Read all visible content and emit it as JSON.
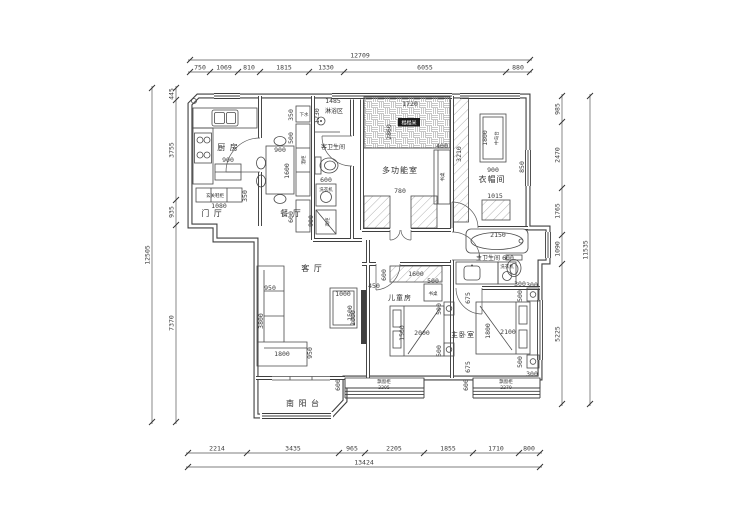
{
  "colors": {
    "line": "#3f3f3f",
    "dim_text": "#3d3d3d",
    "label_text": "#2e2e2e",
    "chip_bg": "#1b1b1b",
    "chip_text": "#ffffff",
    "background": "#ffffff"
  },
  "plan": {
    "rooms": [
      "厨房",
      "门厅",
      "餐厅",
      "淋浴区",
      "客卫生间",
      "多功能室",
      "衣帽间",
      "主卫生间",
      "客厅",
      "儿童房",
      "主卧室",
      "南阳台"
    ],
    "fixtures": [
      "玄关鞋柜",
      "下水",
      "酒柜",
      "洗衣机",
      "高柜",
      "榻榻米",
      "书桌",
      "中岛台",
      "飘窗柜"
    ]
  },
  "dim_chains": [
    {
      "n": "dim-top-total",
      "d": "h",
      "y": 60,
      "a": 190,
      "b": 530,
      "ticks": [
        190,
        530
      ],
      "labels": [
        {
          "t": "12709",
          "p": 360
        }
      ]
    },
    {
      "n": "dim-top-segments",
      "d": "h",
      "y": 72,
      "a": 190,
      "b": 530,
      "ticks": [
        190,
        210,
        238,
        260,
        309,
        344,
        506,
        530
      ],
      "labels": [
        {
          "t": "750",
          "p": 200
        },
        {
          "t": "1069",
          "p": 224
        },
        {
          "t": "810",
          "p": 249
        },
        {
          "t": "1815",
          "p": 284
        },
        {
          "t": "1330",
          "p": 326
        },
        {
          "t": "6055",
          "p": 425
        },
        {
          "t": "880",
          "p": 518
        }
      ]
    },
    {
      "n": "dim-bottom-segments",
      "d": "h",
      "y": 453,
      "a": 188,
      "b": 540,
      "ticks": [
        188,
        247,
        339,
        365,
        424,
        473,
        519,
        540
      ],
      "labels": [
        {
          "t": "2214",
          "p": 217
        },
        {
          "t": "3435",
          "p": 293
        },
        {
          "t": "965",
          "p": 352
        },
        {
          "t": "2205",
          "p": 394
        },
        {
          "t": "1855",
          "p": 448
        },
        {
          "t": "1710",
          "p": 496
        },
        {
          "t": "800",
          "p": 529
        }
      ]
    },
    {
      "n": "dim-bottom-total",
      "d": "h",
      "y": 467,
      "a": 188,
      "b": 540,
      "ticks": [
        188,
        540
      ],
      "labels": [
        {
          "t": "13424",
          "p": 364
        }
      ]
    },
    {
      "n": "dim-left-segments",
      "d": "v",
      "x": 176,
      "a": 88,
      "b": 422,
      "ticks": [
        88,
        100,
        200,
        225,
        422
      ],
      "labels": [
        {
          "t": "445",
          "p": 94
        },
        {
          "t": "3755",
          "p": 150
        },
        {
          "t": "935",
          "p": 212
        },
        {
          "t": "7370",
          "p": 323
        }
      ]
    },
    {
      "n": "dim-left-total",
      "d": "v",
      "x": 152,
      "a": 88,
      "b": 422,
      "ticks": [
        88,
        422
      ],
      "labels": [
        {
          "t": "12505",
          "p": 255
        }
      ]
    },
    {
      "n": "dim-right-segments",
      "d": "v",
      "x": 562,
      "a": 96,
      "b": 404,
      "ticks": [
        96,
        122,
        188,
        235,
        264,
        404
      ],
      "labels": [
        {
          "t": "985",
          "p": 109
        },
        {
          "t": "2470",
          "p": 155
        },
        {
          "t": "1765",
          "p": 211
        },
        {
          "t": "1090",
          "p": 249
        },
        {
          "t": "5225",
          "p": 334
        }
      ]
    },
    {
      "n": "dim-right-total",
      "d": "v",
      "x": 590,
      "a": 96,
      "b": 404,
      "ticks": [
        96,
        404
      ],
      "labels": [
        {
          "t": "11535",
          "p": 250
        }
      ]
    }
  ],
  "annotations": [
    {
      "n": "room-kitchen",
      "t": "厨 房",
      "x": 228,
      "y": 150,
      "s": 8,
      "cls": "room"
    },
    {
      "n": "room-entry",
      "t": "门 厅",
      "x": 212,
      "y": 216,
      "s": 8,
      "cls": "room"
    },
    {
      "n": "room-dining",
      "t": "餐 厅",
      "x": 291,
      "y": 216,
      "s": 8,
      "cls": "room"
    },
    {
      "n": "room-shower",
      "t": "淋浴区",
      "x": 334,
      "y": 113,
      "s": 6,
      "cls": "mid"
    },
    {
      "n": "room-guest-bath",
      "t": "客卫生间",
      "x": 333,
      "y": 149,
      "s": 6,
      "cls": "mid"
    },
    {
      "n": "room-multi",
      "t": "多功能室",
      "x": 400,
      "y": 173,
      "s": 8,
      "cls": "room"
    },
    {
      "n": "room-cloak",
      "t": "衣帽间",
      "x": 492,
      "y": 182,
      "s": 8,
      "cls": "room"
    },
    {
      "n": "room-master-bath",
      "t": "主卫生间",
      "x": 488,
      "y": 260,
      "s": 6,
      "cls": "mid"
    },
    {
      "n": "room-living",
      "t": "客 厅",
      "x": 312,
      "y": 271,
      "s": 8,
      "cls": "room"
    },
    {
      "n": "room-kids",
      "t": "儿童房",
      "x": 400,
      "y": 300,
      "s": 7,
      "cls": "room"
    },
    {
      "n": "room-master",
      "t": "主卧室",
      "x": 463,
      "y": 337,
      "s": 7,
      "cls": "room"
    },
    {
      "n": "room-balcony",
      "t": "南 阳 台",
      "x": 303,
      "y": 406,
      "s": 8,
      "cls": "room"
    },
    {
      "n": "label-shoe-cabinet",
      "t": "玄关鞋柜",
      "x": 215,
      "y": 197,
      "cls": "tiny"
    },
    {
      "n": "label-drain",
      "t": "下水",
      "x": 304,
      "y": 116,
      "cls": "tiny"
    },
    {
      "n": "label-wine-cabinet",
      "t": "酒柜",
      "x": 305,
      "y": 160,
      "r": 1,
      "cls": "tiny"
    },
    {
      "n": "label-washer-guest",
      "t": "洗衣机",
      "x": 326,
      "y": 191,
      "cls": "tiny"
    },
    {
      "n": "label-tall-cabinet",
      "t": "高柜",
      "x": 329,
      "y": 222,
      "r": 1,
      "cls": "tiny"
    },
    {
      "n": "chip-tatami",
      "t": "榻榻米",
      "x": 409,
      "y": 124,
      "c": 1
    },
    {
      "n": "label-desk-multi",
      "t": "书桌",
      "x": 444,
      "y": 177,
      "r": 1,
      "cls": "tiny"
    },
    {
      "n": "label-island",
      "t": "中岛台",
      "x": 498,
      "y": 138,
      "r": 1,
      "cls": "tiny"
    },
    {
      "n": "label-washer-master",
      "t": "洗衣机",
      "x": 507,
      "y": 268,
      "cls": "tiny"
    },
    {
      "n": "label-desk-kids",
      "t": "书桌",
      "x": 433,
      "y": 295,
      "cls": "tiny"
    },
    {
      "n": "label-bay-kids",
      "t": "飘窗柜",
      "x": 384,
      "y": 383,
      "cls": "tiny"
    },
    {
      "n": "dim-bay-kids",
      "t": "2205",
      "x": 384,
      "y": 389,
      "cls": "tiny"
    },
    {
      "n": "label-bay-master",
      "t": "飘窗柜",
      "x": 506,
      "y": 383,
      "cls": "tiny"
    },
    {
      "n": "dim-bay-master",
      "t": "2270",
      "x": 506,
      "y": 389,
      "cls": "tiny"
    },
    {
      "n": "dim-kitchen-cab",
      "t": "900",
      "x": 228,
      "y": 162
    },
    {
      "n": "dim-shoe-w",
      "t": "1080",
      "x": 219,
      "y": 208
    },
    {
      "n": "dim-shoe-d",
      "t": "350",
      "x": 247,
      "y": 196,
      "r": 1
    },
    {
      "n": "dim-table-w",
      "t": "900",
      "x": 280,
      "y": 152
    },
    {
      "n": "dim-table-l",
      "t": "1600",
      "x": 289,
      "y": 171,
      "r": 1
    },
    {
      "n": "dim-shower-w",
      "t": "1485",
      "x": 333,
      "y": 103
    },
    {
      "n": "dim-shower-d",
      "t": "1230",
      "x": 319,
      "y": 116,
      "r": 1
    },
    {
      "n": "dim-drain",
      "t": "350",
      "x": 293,
      "y": 115,
      "r": 1
    },
    {
      "n": "dim-strip-500",
      "t": "500",
      "x": 293,
      "y": 138,
      "r": 1
    },
    {
      "n": "dim-strip-600",
      "t": "600",
      "x": 293,
      "y": 217,
      "r": 1
    },
    {
      "n": "dim-washer-guest",
      "t": "600",
      "x": 326,
      "y": 182
    },
    {
      "n": "dim-tallcab",
      "t": "900",
      "x": 313,
      "y": 221,
      "r": 1
    },
    {
      "n": "dim-tatami-w",
      "t": "1720",
      "x": 410,
      "y": 106
    },
    {
      "n": "dim-multi-d",
      "t": "2860",
      "x": 391,
      "y": 132,
      "r": 1
    },
    {
      "n": "dim-desk-multi",
      "t": "400",
      "x": 442,
      "y": 148
    },
    {
      "n": "dim-multi-door",
      "t": "780",
      "x": 400,
      "y": 193
    },
    {
      "n": "dim-cloak-strip",
      "t": "3210",
      "x": 461,
      "y": 154,
      "r": 1
    },
    {
      "n": "dim-island-l",
      "t": "1800",
      "x": 487,
      "y": 138,
      "r": 1
    },
    {
      "n": "dim-island-w",
      "t": "900",
      "x": 493,
      "y": 172
    },
    {
      "n": "dim-cloak-1015",
      "t": "1015",
      "x": 495,
      "y": 198
    },
    {
      "n": "dim-cloak-win",
      "t": "850",
      "x": 524,
      "y": 167,
      "r": 1
    },
    {
      "n": "dim-tub",
      "t": "2150",
      "x": 498,
      "y": 237
    },
    {
      "n": "dim-washer-master",
      "t": "600",
      "x": 508,
      "y": 260
    },
    {
      "n": "dim-mbath-300",
      "t": "300",
      "x": 520,
      "y": 286
    },
    {
      "n": "dim-sofa-d",
      "t": "950",
      "x": 270,
      "y": 290
    },
    {
      "n": "dim-sofa-l",
      "t": "3800",
      "x": 263,
      "y": 321,
      "r": 1
    },
    {
      "n": "dim-chaise-w",
      "t": "1800",
      "x": 282,
      "y": 356
    },
    {
      "n": "dim-chaise-d",
      "t": "950",
      "x": 312,
      "y": 353,
      "r": 1
    },
    {
      "n": "dim-ctable-w",
      "t": "1000",
      "x": 343,
      "y": 296
    },
    {
      "n": "dim-ctable-l",
      "t": "1500",
      "x": 352,
      "y": 313,
      "r": 1
    },
    {
      "n": "dim-tv-l",
      "t": "2000",
      "x": 355,
      "y": 318,
      "r": 1
    },
    {
      "n": "dim-tv-d",
      "t": "450",
      "x": 374,
      "y": 288
    },
    {
      "n": "dim-wardrobe-kids",
      "t": "1600",
      "x": 416,
      "y": 276
    },
    {
      "n": "dim-wardrobe-kids-d",
      "t": "600",
      "x": 386,
      "y": 275,
      "r": 1
    },
    {
      "n": "dim-desk-kids",
      "t": "500",
      "x": 433,
      "y": 283
    },
    {
      "n": "dim-nstand-kids1",
      "t": "500",
      "x": 441,
      "y": 309,
      "r": 1
    },
    {
      "n": "dim-bed-kids-w",
      "t": "2000",
      "x": 422,
      "y": 335
    },
    {
      "n": "dim-bed-kids-l",
      "t": "1500",
      "x": 404,
      "y": 333,
      "r": 1
    },
    {
      "n": "dim-nstand-kids2",
      "t": "500",
      "x": 441,
      "y": 351,
      "r": 1
    },
    {
      "n": "dim-bay-kids-d",
      "t": "600",
      "x": 340,
      "y": 385,
      "r": 1
    },
    {
      "n": "dim-mbed-gap1",
      "t": "675",
      "x": 470,
      "y": 298,
      "r": 1
    },
    {
      "n": "dim-mbed-l",
      "t": "1800",
      "x": 490,
      "y": 331,
      "r": 1
    },
    {
      "n": "dim-mbed-w",
      "t": "2100",
      "x": 508,
      "y": 334
    },
    {
      "n": "dim-mnstand1",
      "t": "500",
      "x": 522,
      "y": 296,
      "r": 1
    },
    {
      "n": "dim-mnstand1-d",
      "t": "300",
      "x": 532,
      "y": 287
    },
    {
      "n": "dim-mnstand2",
      "t": "500",
      "x": 522,
      "y": 362,
      "r": 1
    },
    {
      "n": "dim-mnstand2-d",
      "t": "300",
      "x": 532,
      "y": 376
    },
    {
      "n": "dim-mbed-gap2",
      "t": "675",
      "x": 470,
      "y": 367,
      "r": 1
    },
    {
      "n": "dim-bay-master-d",
      "t": "600",
      "x": 468,
      "y": 385,
      "r": 1
    }
  ]
}
